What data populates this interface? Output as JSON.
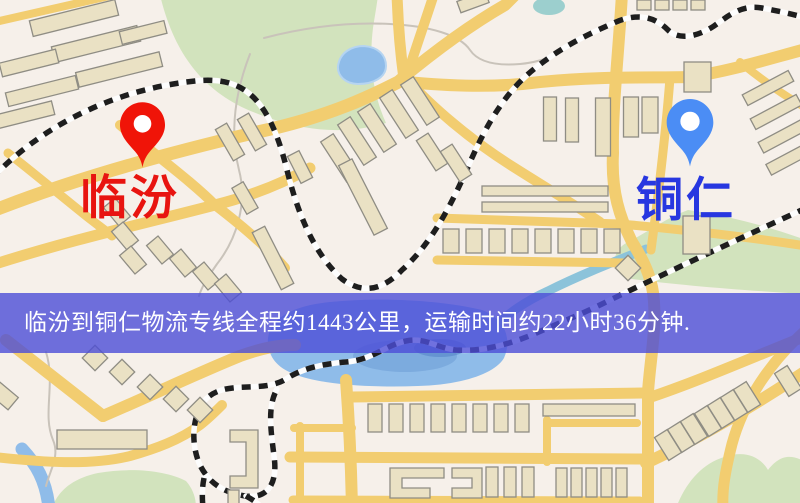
{
  "map": {
    "origin": {
      "name": "临汾"
    },
    "destination": {
      "name": "铜仁"
    }
  },
  "banner": {
    "text": "临汾到铜仁物流专线全程约1443公里，运输时间约22小时36分钟."
  },
  "colors": {
    "map-bg": "#f6f0ea",
    "road": "#f2cd70",
    "building": "#eae1c4",
    "building-stroke": "#8f8d84",
    "green": "#d2e3bd",
    "water": "#8fbce9",
    "rail-dark": "#1e1e1e",
    "rail-light": "#fdfdfd",
    "banner-bg": "rgba(76,78,215,0.8)",
    "banner-text": "#ffffff",
    "origin-accent": "#e81410",
    "destination-accent": "#2737e0",
    "origin-pin": "#f01408",
    "destination-pin": "#4b8df5"
  }
}
